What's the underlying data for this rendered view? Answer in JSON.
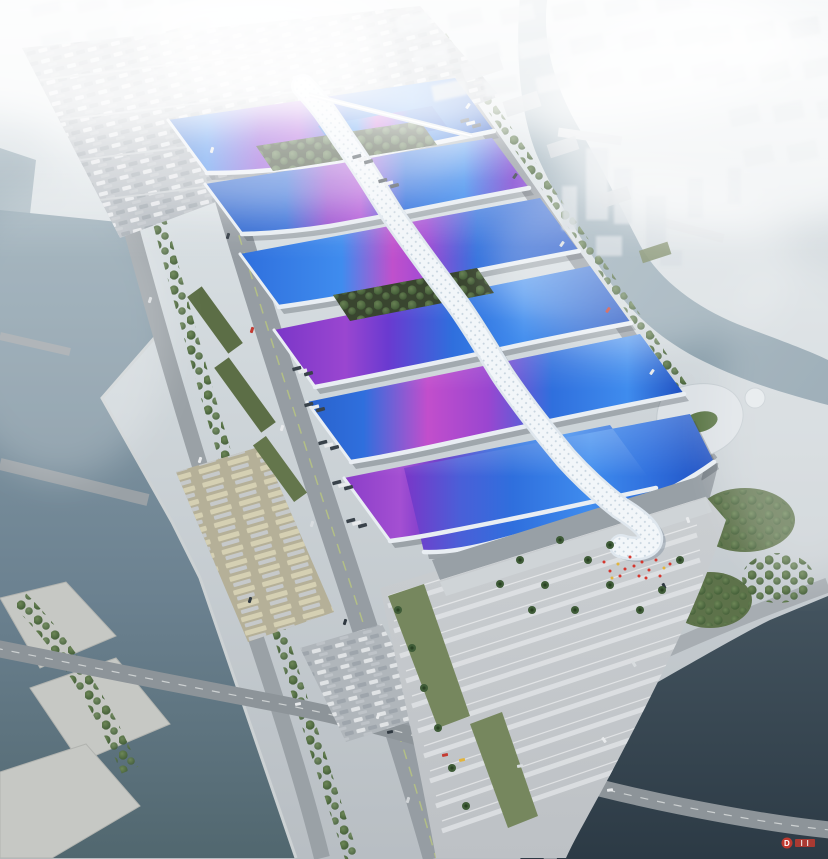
{
  "scene": {
    "subject": "aerial rendering of a large exhibition and convention center complex",
    "features": {
      "central_spine": "white serpentine ribbon roof running diagonally through the complex",
      "halls": "rows of blue exhibition hall roofs with purple and magenta ribbon stripes",
      "surroundings": "rivers, roads, parking lots, tree-lined boulevards, hazy city skyline"
    }
  },
  "watermark": {
    "letter": "D",
    "color": "#c0392f"
  },
  "colors": {
    "roof_blue": "#2f6fdd",
    "roof_blue_light": "#3f8cee",
    "roof_blue_dark": "#1f4fc0",
    "ribbon_purple": "#9a46d0",
    "ribbon_magenta": "#c24ecc",
    "spine_white": "#f2f6f9",
    "water": "#8da2ae",
    "water_dark": "#3a4a55",
    "greenery": "#4f6a42",
    "paving": "#c6cacc",
    "road": "#8e959b",
    "haze": "#e8eef1",
    "people_red": "#d4372e"
  }
}
